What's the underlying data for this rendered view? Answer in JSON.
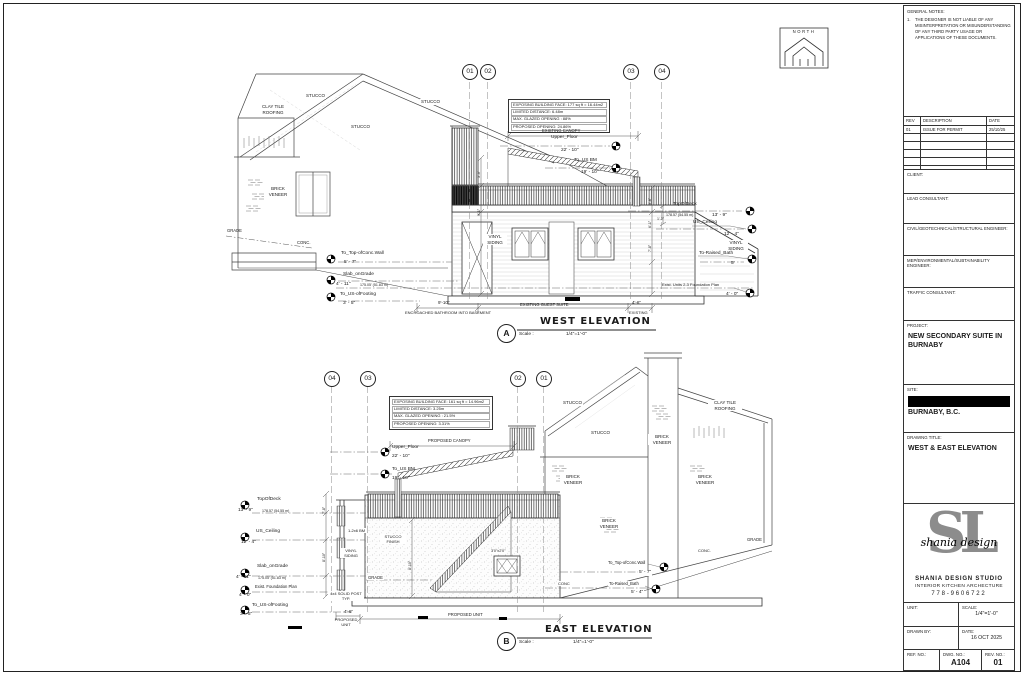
{
  "sheet": {
    "north_label": "NORTH"
  },
  "west": {
    "bubbles": [
      "01",
      "02",
      "03",
      "04"
    ],
    "info_box": [
      "EXPOSING BUILDING FACE: 177 sq ft = 16.44m2",
      "LIMITED DISTANCE: 6.48m",
      "MAX. GLAZED OPENING : 88%",
      "PROPOSED OPENING: 24.86%"
    ],
    "materials": {
      "clay_tile": "CLAY TILE ROOFING",
      "stucco_a": "STUCCO",
      "stucco_b": "STUCCO",
      "stucco_c": "STUCCO",
      "brick_veneer": "BRICK VENEER",
      "grade": "GRADE",
      "conc": "CONC.",
      "vinyl_siding_l": "VINYL SIDING",
      "vinyl_siding_r": "VINYL SIDING",
      "existing_canopy": "EXISTING CANOPY"
    },
    "levels": {
      "upper_floor": {
        "name": "Upper_Floor",
        "value": "22' - 10\""
      },
      "to_us_bm": {
        "name": "To_US BM",
        "value": "19' - 10\""
      },
      "top_of_deck": {
        "name": "TopOfDeck",
        "elev": "178.57 (54.55 m)",
        "value": "13' - 9\""
      },
      "us_ceiling": {
        "name": "US_Ceiling",
        "value": "12' - 4\""
      },
      "to_raised_bath": {
        "name": "To-Raised_Bath",
        "value": "5'"
      },
      "foundation": {
        "name": "Exist. Units 2-3 Foundation Plan",
        "value": "4' - 0\""
      },
      "top_conc_wall": {
        "name": "To_Top-ofConc.Wall",
        "value": "5' - 7\""
      },
      "slab_on_grade": {
        "name": "Slab_onGrade",
        "elev": "175.05' (51.83 m)",
        "value": "4' - 11\""
      },
      "us_footing": {
        "name": "To_US-ofFooting",
        "value": "3' - 5\""
      }
    },
    "dims": {
      "left_run": "9'-10\"",
      "guest_suite": "EXISTING GUEST SUITE",
      "right_run": "4'-6\"",
      "existing": "EXISTING",
      "encroached": "ENCROACHED BATHROOM INTO BASEMENT",
      "v1": "3'-0\"",
      "v2": "9'-1\"",
      "v3": "3'-8\"",
      "v4": "6'-1\"",
      "v5": "7'-8\"",
      "v6": "1'-2\""
    },
    "title": {
      "bubble": "A",
      "name": "WEST ELEVATION",
      "scale_label": "Scale :",
      "scale_value": "1/4\"=1'-0\""
    }
  },
  "east": {
    "bubbles": [
      "04",
      "03",
      "02",
      "01"
    ],
    "info_box": [
      "EXPOSING BUILDING FACE: 161 sq ft = 14.96m2",
      "LIMITED DISTANCE: 3.25m",
      "MAX. GLAZED OPENING : 21.5%",
      "PROPOSED OPENING: 3.31%"
    ],
    "materials": {
      "stucco_a": "STUCCO",
      "stucco_b": "STUCCO",
      "stucco_finish": "STUCCO FINISH",
      "brick_chimney": "BRICK VENEER",
      "brick_l": "BRICK VENEER",
      "brick_r": "BRICK VENEER",
      "brick_c": "BRICK VENEER",
      "clay_tile": "CLAY TILE ROOFING",
      "vinyl_siding": "VINYL SIDING",
      "grade_l": "GRADE",
      "grade_r": "GRADE",
      "conc_l": "CONC",
      "conc_r": "CONC.",
      "proposed_canopy": "PROPOSED CANOPY",
      "bm": "1-2x6 BM",
      "post": "4x4 SOLID POST TYP.",
      "window_size": "3'0\"x2'0\"",
      "proposed_unit": "PROPOSED UNIT",
      "proposed_left": "PROPOSED UNIT"
    },
    "levels": {
      "upper_floor": {
        "name": "Upper_Floor",
        "value": "22' - 10\""
      },
      "to_us_bm": {
        "name": "To_US BM",
        "value": "19' - 10\""
      },
      "top_of_deck": {
        "name": "TopOfDeck",
        "value": "13' - 9\"",
        "elev": "178.57 (54.55 m)"
      },
      "us_ceiling": {
        "name": "US_Ceiling",
        "value": "12' - 4\""
      },
      "slab_on_grade": {
        "name": "Slab_onGrade",
        "value": "4' - 11\"",
        "elev": "175.05' (51.83 m)"
      },
      "foundation": {
        "name": "Exist. Foundation Plan",
        "value": "4' - 0\""
      },
      "us_footing": {
        "name": "To_US-ofFooting",
        "value": "3' - 5\""
      },
      "top_conc_wall": {
        "name": "To_Top-ofConc.Wall",
        "value": "5' - 7\""
      },
      "to_raised_bath": {
        "name": "To-Raised_Bath",
        "value": "5' - 4\""
      }
    },
    "dims": {
      "left_run": "4'-6\"",
      "v1": "7'-8\"",
      "v2": "8'-10\"",
      "v3": "8'-10\""
    },
    "title": {
      "bubble": "B",
      "name": "EAST ELEVATION",
      "scale_label": "Scale :",
      "scale_value": "1/4\"=1'-0\""
    }
  },
  "titleblock": {
    "general_notes": {
      "title": "GENERAL NOTES:",
      "number": "1.",
      "text": "THE DESIGNER IS NOT LIABLE OF ANY MISINTERPRETATION OR MISUNDERSTANDING OF ANY THIRD PARTY USAGE OR APPLICATIONS OF THESE DOCUMENTS."
    },
    "revisions": {
      "headers": [
        "REV",
        "DESCRIPTION",
        "DATE"
      ],
      "rows": [
        [
          "01",
          "ISSUE FOR PERMIT",
          "25/10/25"
        ]
      ]
    },
    "fields": [
      {
        "label": "CLIENT:"
      },
      {
        "label": "LEAD CONSULTANT:"
      },
      {
        "label": "CIVIL/GEOTECHNICAL/STRUCTURAL ENGINEER:"
      },
      {
        "label": "MEP/ENVIRONMENTAL/SUBTAINABILITY ENGINEER:"
      },
      {
        "label": "TRAFFIC CONSULTANT:"
      }
    ],
    "project": {
      "label": "PROJECT:",
      "value": "NEW SECONDARY SUITE IN BURNABY"
    },
    "site": {
      "label": "SITE:",
      "value": "BURNABY, B.C."
    },
    "drawing_title": {
      "label": "DRAWING TITLE:",
      "value": "WEST & EAST ELEVATION"
    },
    "studio": {
      "monogram": "SL",
      "script": "shania design",
      "name": "SHANIA DESIGN STUDIO",
      "tagline": "INTERIOR  KITCHEN  ARCHECTURE",
      "phone": "778-9606722"
    },
    "grid": {
      "unit": "UNIT:",
      "scale": "SCALE:",
      "scale_value": "1/4\"=1'-0\"",
      "drawn_by": "DRAWN BY:",
      "date": "DATE:",
      "date_value": "16 OCT 2025",
      "ref": "REF. NO.:",
      "dwg": "DWG. NO.:",
      "dwg_value": "A104",
      "rev": "REV. NO.:",
      "rev_value": "01"
    }
  }
}
